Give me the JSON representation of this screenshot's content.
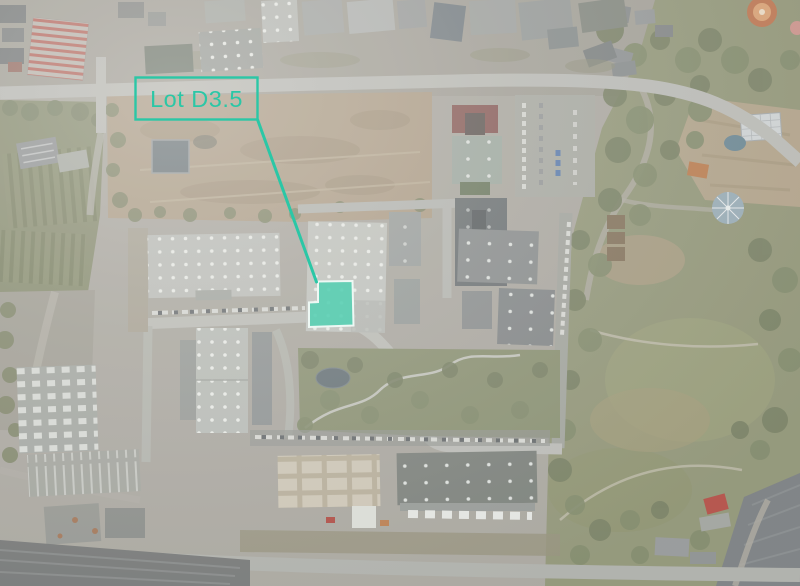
{
  "annotation": {
    "label": "Lot D3.5",
    "accent_color": "#2bc7a6",
    "lot_fill_color": "#57cfb3",
    "lot_border_color": "#eef8f4"
  }
}
